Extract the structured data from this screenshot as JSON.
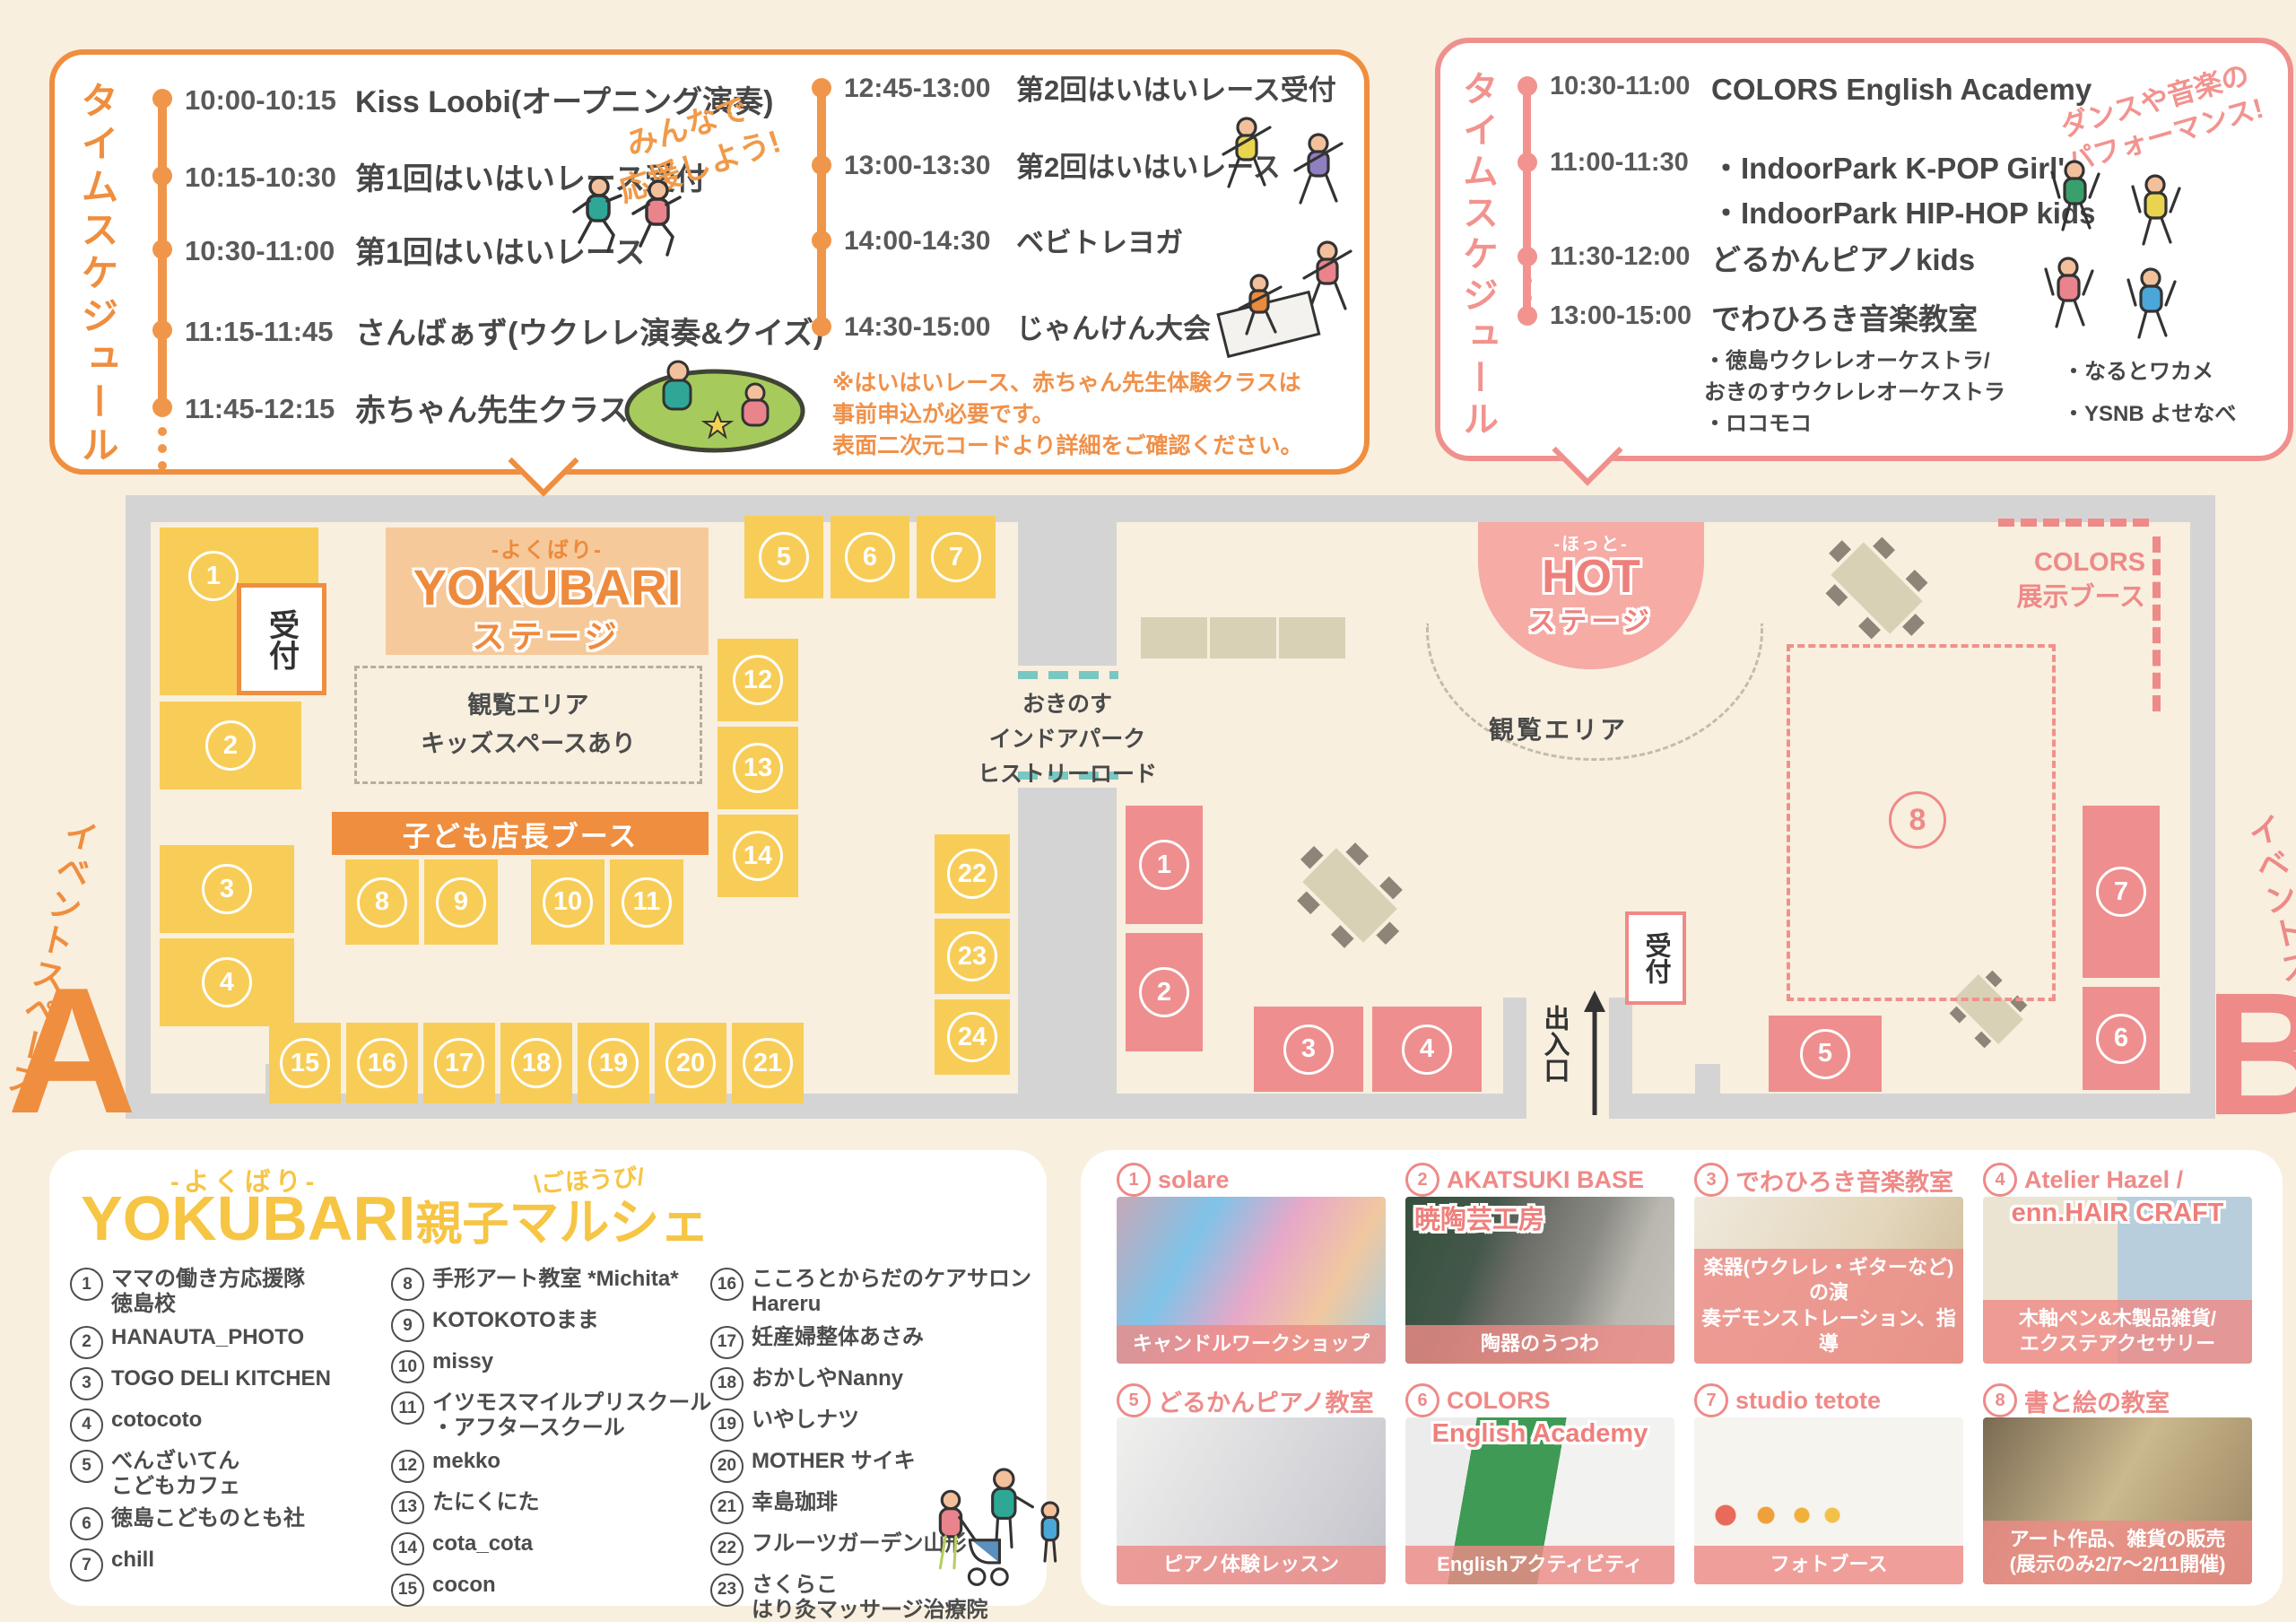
{
  "left_schedule": {
    "title": "タイムスケジュール",
    "cheer": "みんなで\n応援しよう!",
    "col1": [
      {
        "time": "10:00-10:15",
        "label": "Kiss Loobi(オープニング演奏)"
      },
      {
        "time": "10:15-10:30",
        "label": "第1回はいはいレース受付"
      },
      {
        "time": "10:30-11:00",
        "label": "第1回はいはいレース"
      },
      {
        "time": "11:15-11:45",
        "label": "さんばぁず(ウクレレ演奏&クイズ)"
      },
      {
        "time": "11:45-12:15",
        "label": "赤ちゃん先生クラス体験会"
      }
    ],
    "col2": [
      {
        "time": "12:45-13:00",
        "label": "第2回はいはいレース受付"
      },
      {
        "time": "13:00-13:30",
        "label": "第2回はいはいレース"
      },
      {
        "time": "14:00-14:30",
        "label": "ベビトレヨガ"
      },
      {
        "time": "14:30-15:00",
        "label": "じゃんけん大会"
      }
    ],
    "note": "※はいはいレース、赤ちゃん先生体験クラスは\n事前申込が必要です。\n表面二次元コードより詳細をご確認ください。"
  },
  "right_schedule": {
    "title": "タイムスケジュール",
    "cheer": "ダンスや音楽の\nパフォーマンス!",
    "rows": [
      {
        "time": "10:30-11:00",
        "label": "COLORS English Academy"
      },
      {
        "time": "11:00-11:30",
        "label": "・IndoorPark K-POP Girl's\n・IndoorPark HIP-HOP kids"
      },
      {
        "time": "11:30-12:00",
        "label": "どるかんピアノkids"
      },
      {
        "time": "13:00-15:00",
        "label": "でわひろき音楽教室"
      }
    ],
    "sub_left": "・徳島ウクレレオーケストラ/\n おきのすウクレレオーケストラ\n・ロコモコ",
    "sub_right": "・なるとワカメ\n・YSNB よせなべ"
  },
  "map": {
    "yokubari_stage": {
      "pre": "-よくばり-",
      "main": "YOKUBARI",
      "sub": "ステージ"
    },
    "hot_stage": {
      "pre": "-ほっと-",
      "main": "HOT",
      "sub": "ステージ"
    },
    "reception": "受付",
    "viewing_left": "観覧エリア\nキッズスペースあり",
    "viewing_right": "観覧エリア",
    "kids_banner": "子ども店長ブース",
    "corridor": "おきのす\nインドアパーク\nヒストリーロード",
    "colors_booth": "COLORS\n展示ブース",
    "exit": "出入口",
    "space_a": {
      "label": "イベントスペース",
      "letter": "A"
    },
    "space_b": {
      "label": "イベントスペース",
      "letter": "B"
    },
    "booths_a": [
      "1",
      "2",
      "3",
      "4",
      "5",
      "6",
      "7",
      "8",
      "9",
      "10",
      "11",
      "12",
      "13",
      "14",
      "15",
      "16",
      "17",
      "18",
      "19",
      "20",
      "21",
      "22",
      "23",
      "24"
    ],
    "booths_b": [
      "1",
      "2",
      "3",
      "4",
      "5",
      "6",
      "7",
      "8"
    ]
  },
  "marche": {
    "pre": "-よくばり-",
    "main": "YOKUBARI",
    "suffix": "親子",
    "suffix2": "マルシェ",
    "badge": "\\ごほうび/",
    "col1": [
      {
        "num": "1",
        "name": "ママの働き方応援隊\n徳島校"
      },
      {
        "num": "2",
        "name": "HANAUTA_PHOTO"
      },
      {
        "num": "3",
        "name": "TOGO DELI KITCHEN"
      },
      {
        "num": "4",
        "name": "cotocoto"
      },
      {
        "num": "5",
        "name": "べんざいてん\nこどもカフェ"
      },
      {
        "num": "6",
        "name": "徳島こどものとも社"
      },
      {
        "num": "7",
        "name": "chill"
      }
    ],
    "col2": [
      {
        "num": "8",
        "name": "手形アート教室 *Michita*"
      },
      {
        "num": "9",
        "name": "KOTOKOTOまま"
      },
      {
        "num": "10",
        "name": "missy"
      },
      {
        "num": "11",
        "name": "イツモスマイルプリスクール\n・アフタースクール"
      },
      {
        "num": "12",
        "name": "mekko"
      },
      {
        "num": "13",
        "name": "たにくにた"
      },
      {
        "num": "14",
        "name": "cota_cota"
      },
      {
        "num": "15",
        "name": "cocon"
      }
    ],
    "col3": [
      {
        "num": "16",
        "name": "こころとからだのケアサロン\nHareru"
      },
      {
        "num": "17",
        "name": "妊産婦整体あさみ"
      },
      {
        "num": "18",
        "name": "おかしやNanny"
      },
      {
        "num": "19",
        "name": "いやしナツ"
      },
      {
        "num": "20",
        "name": "MOTHER サイキ"
      },
      {
        "num": "21",
        "name": "幸島珈琲"
      },
      {
        "num": "22",
        "name": "フルーツガーデン山形"
      },
      {
        "num": "23",
        "name": "さくらこ\nはり灸マッサージ治療院"
      },
      {
        "num": "24",
        "name": "moi!"
      }
    ]
  },
  "cards": [
    {
      "num": "1",
      "title": "solare",
      "caption": "キャンドルワークショップ"
    },
    {
      "num": "2",
      "title": "AKATSUKI BASE",
      "overlay": "暁陶芸工房",
      "caption": "陶器のうつわ"
    },
    {
      "num": "3",
      "title": "でわひろき音楽教室",
      "caption": "楽器(ウクレレ・ギターなど)の演\n奏デモンストレーション、指導"
    },
    {
      "num": "4",
      "title": "Atelier Hazel /",
      "overlay": "enn.HAIR CRAFT",
      "caption": "木軸ペン&木製品雑貨/\nエクステアクセサリー"
    },
    {
      "num": "5",
      "title": "どるかんピアノ教室",
      "caption": "ピアノ体験レッスン"
    },
    {
      "num": "6",
      "title": "COLORS",
      "overlay": "English Academy",
      "caption": "Englishアクティビティ"
    },
    {
      "num": "7",
      "title": "studio tetote",
      "caption": "フォトブース"
    },
    {
      "num": "8",
      "title": "書と絵の教室",
      "caption": "アート作品、雑貨の販売\n(展示のみ2/7〜2/11開催)"
    }
  ],
  "colors": {
    "orange": "#ef8e3e",
    "pink": "#ee8a88",
    "yellow_booth": "#f8cd57",
    "pink_booth": "#ef8e8e",
    "yellow_title": "#f6c544",
    "teal": "#79c7c2",
    "wall": "#d4d4d4",
    "cream": "#f8efdf"
  },
  "illustrations": [
    "runners",
    "picnic-mat-group",
    "yoga-group",
    "dance-group",
    "family-stroller",
    "exit-arrow"
  ]
}
